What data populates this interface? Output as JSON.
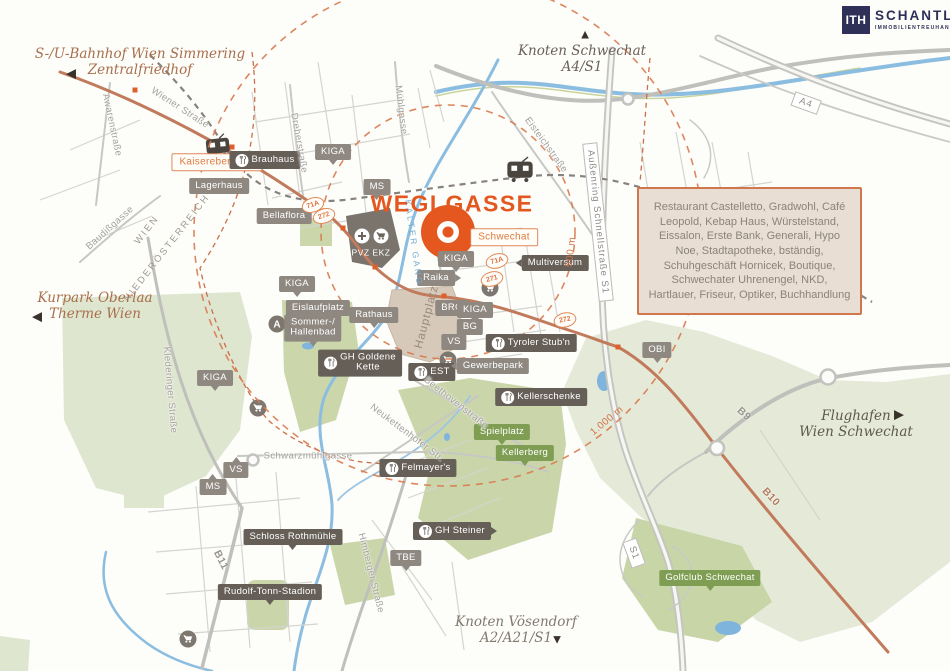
{
  "colors": {
    "accent_orange": "#E4571E",
    "brand_navy": "#2E3057",
    "ring_orange": "#D97A4F",
    "water_blue": "#8ABDE0",
    "green_light": "#DFE6D0",
    "green_mid": "#CAD6AA"
  },
  "brand": {
    "logo_mark": "ITH",
    "name": "SCHANTL",
    "subtitle": "IMMOBILIENTREUHAND"
  },
  "project": {
    "title": "WEGLGASSE"
  },
  "info_box": {
    "text": "Restaurant Castelletto, Gradwohl, Café Leopold, Kebap Haus, Würstelstand, Eissalon, Erste Bank, Generali, Hypo Noe, Stadtapotheke,  bständig, Schuhgeschäft Hornicek, Boutique, Schwechater Uhrenengel, NKD, Hartlauer, Friseur, Optiker, Buchhandlung"
  },
  "signposts": [
    {
      "id": "simmering",
      "lines": [
        "S-/U-Bahnhof Wien Simmering",
        "Zentralfriedhof"
      ],
      "arrow": "left",
      "x": 140,
      "y": 62,
      "ax": 71,
      "ay": 73,
      "color": "#a96f4c"
    },
    {
      "id": "knoten-schwechat",
      "lines": [
        "Knoten Schwechat",
        "A4/S1"
      ],
      "arrow": "up",
      "x": 582,
      "y": 59,
      "ax": 585,
      "ay": 34,
      "color": "#6b6157"
    },
    {
      "id": "kurpark-oberlaa",
      "lines": [
        "Kurpark Oberlaa",
        "Therme Wien"
      ],
      "arrow": "left",
      "x": 95,
      "y": 306,
      "ax": 37,
      "ay": 316,
      "color": "#a96f4c"
    },
    {
      "id": "flughafen",
      "lines": [
        "Flughafen",
        "Wien Schwechat"
      ],
      "arrow": "right",
      "x": 856,
      "y": 424,
      "ax": 899,
      "ay": 414,
      "color": "#5f584e"
    },
    {
      "id": "knoten-voesendorf",
      "lines": [
        "Knoten Vösendorf",
        "A2/A21/S1"
      ],
      "arrow": "down",
      "x": 516,
      "y": 630,
      "ax": 557,
      "ay": 639,
      "color": "#827970"
    }
  ],
  "distance_rings": {
    "center": {
      "x": 448,
      "y": 232
    },
    "rings": [
      {
        "radius_px": 127,
        "label": "500 m",
        "x": 571,
        "y": 252,
        "rot": -83
      },
      {
        "radius_px": 254,
        "label": "1.000 m",
        "x": 607,
        "y": 421,
        "rot": -40
      }
    ]
  },
  "pois": [
    {
      "label": "Kaiserebersdorf",
      "x": 217,
      "y": 162,
      "v": "outline",
      "p": "none"
    },
    {
      "label": "Brauhaus",
      "x": 265,
      "y": 160,
      "v": "dark",
      "p": "none",
      "icon": "restaurant"
    },
    {
      "label": "Lagerhaus",
      "x": 219,
      "y": 186,
      "v": "gray",
      "p": "none"
    },
    {
      "label": "Bellaflora",
      "x": 284,
      "y": 216,
      "v": "gray",
      "p": "none"
    },
    {
      "label": "KIGA",
      "x": 333,
      "y": 152,
      "v": "gray",
      "p": "down"
    },
    {
      "label": "MS",
      "x": 377,
      "y": 187,
      "v": "gray",
      "p": "down"
    },
    {
      "label": "PVZ EKZ",
      "x": 371,
      "y": 253,
      "v": "area",
      "p": "none"
    },
    {
      "label": "Schwechat",
      "x": 504,
      "y": 237,
      "v": "outline",
      "p": "none"
    },
    {
      "label": "Multiversum",
      "x": 555,
      "y": 263,
      "v": "dark",
      "p": "left"
    },
    {
      "label": "KIGA",
      "x": 456,
      "y": 259,
      "v": "gray",
      "p": "down"
    },
    {
      "label": "Raika",
      "x": 436,
      "y": 278,
      "v": "gray",
      "p": "right"
    },
    {
      "label": "BRG",
      "x": 452,
      "y": 308,
      "v": "gray",
      "p": "none"
    },
    {
      "label": "KIGA",
      "x": 475,
      "y": 310,
      "v": "gray",
      "p": "down"
    },
    {
      "label": "BG",
      "x": 470,
      "y": 327,
      "v": "gray",
      "p": "none"
    },
    {
      "label": "VS",
      "x": 454,
      "y": 342,
      "v": "gray",
      "p": "none"
    },
    {
      "label": "Eislaufplatz",
      "x": 318,
      "y": 308,
      "v": "gray",
      "p": "none"
    },
    {
      "label": "Sommer-/\nHallenbad",
      "x": 313,
      "y": 328,
      "v": "gray",
      "p": "down"
    },
    {
      "label": "Rathaus",
      "x": 374,
      "y": 315,
      "v": "gray",
      "p": "down"
    },
    {
      "label": "GH Goldene\nKette",
      "x": 360,
      "y": 363,
      "v": "dark",
      "p": "none",
      "icon": "restaurant"
    },
    {
      "label": "EST",
      "x": 432,
      "y": 372,
      "v": "dark",
      "p": "none",
      "icon": "restaurant"
    },
    {
      "label": "Gewerbepark",
      "x": 493,
      "y": 366,
      "v": "gray",
      "p": "left"
    },
    {
      "label": "Tyroler Stub'n",
      "x": 531,
      "y": 343,
      "v": "dark",
      "p": "none",
      "icon": "restaurant"
    },
    {
      "label": "OBI",
      "x": 657,
      "y": 350,
      "v": "gray",
      "p": "down"
    },
    {
      "label": "Kellerschenke",
      "x": 541,
      "y": 397,
      "v": "dark",
      "p": "none",
      "icon": "restaurant"
    },
    {
      "label": "Spielplatz",
      "x": 502,
      "y": 432,
      "v": "green",
      "p": "down"
    },
    {
      "label": "Kellerberg",
      "x": 525,
      "y": 453,
      "v": "green",
      "p": "down"
    },
    {
      "label": "Felmayer's",
      "x": 418,
      "y": 468,
      "v": "dark",
      "p": "none",
      "icon": "restaurant"
    },
    {
      "label": "GH Steiner",
      "x": 452,
      "y": 531,
      "v": "dark",
      "p": "right",
      "icon": "restaurant"
    },
    {
      "label": "TBE",
      "x": 406,
      "y": 558,
      "v": "gray",
      "p": "down"
    },
    {
      "label": "Schloss Rothmühle",
      "x": 293,
      "y": 537,
      "v": "dark",
      "p": "down"
    },
    {
      "label": "Rudolf-Tonn-Stadion",
      "x": 270,
      "y": 592,
      "v": "dark",
      "p": "down"
    },
    {
      "label": "Golfclub Schwechat",
      "x": 710,
      "y": 578,
      "v": "green",
      "p": "down"
    },
    {
      "label": "MS",
      "x": 213,
      "y": 487,
      "v": "gray",
      "p": "up"
    },
    {
      "label": "VS",
      "x": 236,
      "y": 470,
      "v": "gray",
      "p": "up"
    },
    {
      "label": "KIGA",
      "x": 215,
      "y": 378,
      "v": "gray",
      "p": "down"
    },
    {
      "label": "KIGA",
      "x": 297,
      "y": 284,
      "v": "gray",
      "p": "down"
    }
  ],
  "streets": [
    {
      "label": "Wiener Straße",
      "x": 180,
      "y": 108,
      "rot": 33
    },
    {
      "label": "Awarenstraße",
      "x": 112,
      "y": 125,
      "rot": 78
    },
    {
      "label": "Baudißgasse",
      "x": 110,
      "y": 228,
      "rot": -42
    },
    {
      "label": "Dreherstraße",
      "x": 299,
      "y": 143,
      "rot": 80
    },
    {
      "label": "Mühlgasse",
      "x": 401,
      "y": 110,
      "rot": 83
    },
    {
      "label": "Eisteichstraße",
      "x": 546,
      "y": 145,
      "rot": 54
    },
    {
      "label": "Klederinger Straße",
      "x": 170,
      "y": 390,
      "rot": 85
    },
    {
      "label": "Schwarzmühlgasse",
      "x": 308,
      "y": 456,
      "rot": 0
    },
    {
      "label": "Neukettenhofer Str.",
      "x": 407,
      "y": 433,
      "rot": 37
    },
    {
      "label": "Beethovenstraße",
      "x": 456,
      "y": 403,
      "rot": 38
    },
    {
      "label": "Himberger Straße",
      "x": 371,
      "y": 573,
      "rot": 76
    }
  ],
  "road_labels": [
    {
      "label": "A4",
      "x": 806,
      "y": 103,
      "rot": 20,
      "boxed": true,
      "color": "#8f8b85"
    },
    {
      "label": "S1",
      "x": 634,
      "y": 553,
      "rot": 70,
      "boxed": true,
      "color": "#8f8b85"
    },
    {
      "label": "Außenring Schnellstraße S1",
      "x": 598,
      "y": 222,
      "rot": 84,
      "boxed": true,
      "color": "#8f8b85"
    },
    {
      "label": "B9",
      "x": 744,
      "y": 414,
      "rot": 42,
      "boxed": false,
      "color": "#98948e"
    },
    {
      "label": "B10",
      "x": 771,
      "y": 497,
      "rot": 47,
      "boxed": false,
      "color": "#b27c60"
    },
    {
      "label": "B11",
      "x": 221,
      "y": 560,
      "rot": 63,
      "boxed": false,
      "color": "#98948e"
    }
  ],
  "route_badges": [
    {
      "label": "71A",
      "x": 313,
      "y": 205,
      "rot": -18
    },
    {
      "label": "272",
      "x": 324,
      "y": 216,
      "rot": -18
    },
    {
      "label": "71A",
      "x": 497,
      "y": 261,
      "rot": -15
    },
    {
      "label": "271",
      "x": 492,
      "y": 279,
      "rot": -15
    },
    {
      "label": "272",
      "x": 565,
      "y": 320,
      "rot": -12
    }
  ],
  "region_labels": [
    {
      "label": "WIEN",
      "x": 147,
      "y": 230,
      "rot": -52
    },
    {
      "label": "NIEDERÖSTERREICH",
      "x": 167,
      "y": 248,
      "rot": -52
    }
  ],
  "area_labels": [
    {
      "label": "Hauptplatz",
      "x": 427,
      "y": 317,
      "rot": -75
    }
  ],
  "water_labels": [
    {
      "label": "Kalter Gang",
      "x": 414,
      "y": 243,
      "rot": 82
    }
  ]
}
